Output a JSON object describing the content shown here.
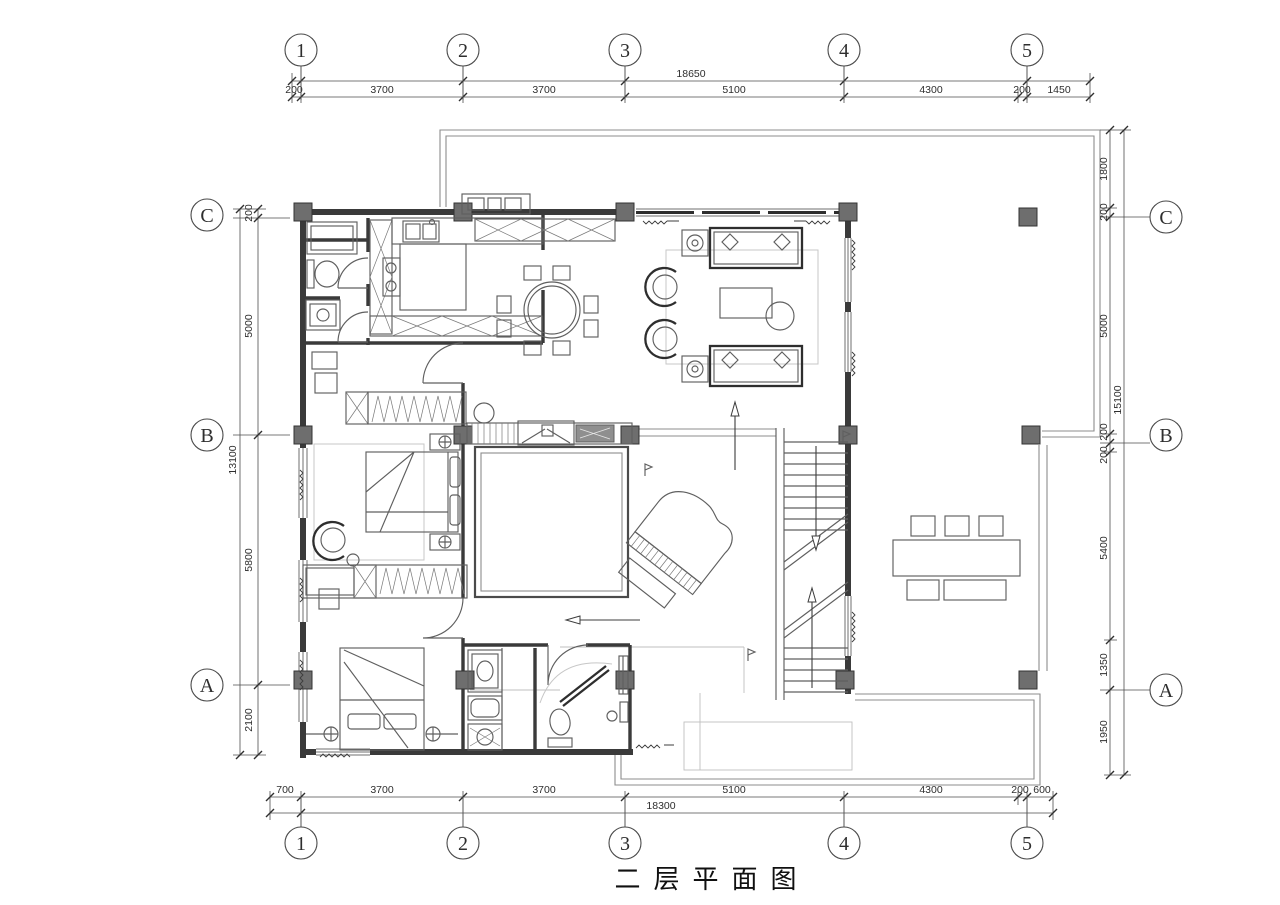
{
  "meta": {
    "title_label": "二层平面图"
  },
  "colors": {
    "line": "#3a3a3a",
    "light_line": "#8c8c8c",
    "column_fill": "#6e6e6e",
    "text": "#2e2e2e",
    "background": "#ffffff"
  },
  "axes": {
    "top": {
      "bubbles": [
        "1",
        "2",
        "3",
        "4",
        "5"
      ],
      "total": "18650",
      "segments": [
        "200",
        "3700",
        "3700",
        "5100",
        "4300",
        "200",
        "1450"
      ]
    },
    "bottom": {
      "bubbles": [
        "1",
        "2",
        "3",
        "4",
        "5"
      ],
      "total": "18300",
      "segments": [
        "700",
        "3700",
        "3700",
        "5100",
        "4300",
        "200",
        "600"
      ]
    },
    "left": {
      "bubbles": [
        "C",
        "B",
        "A"
      ],
      "total": "13100",
      "segments": [
        "200",
        "5000",
        "5800",
        "2100"
      ]
    },
    "right": {
      "bubbles": [
        "C",
        "B",
        "A"
      ],
      "total": "15100",
      "segments": [
        "1800",
        "200",
        "5000",
        "200",
        "200",
        "5400",
        "1350",
        "1950"
      ]
    }
  },
  "symbols": {
    "stair_up_arrow": "up-direction-arrow",
    "stair_down_arrow": "down-direction-arrow",
    "grand_piano": "grand-piano",
    "void_opening": "double-height-void"
  }
}
